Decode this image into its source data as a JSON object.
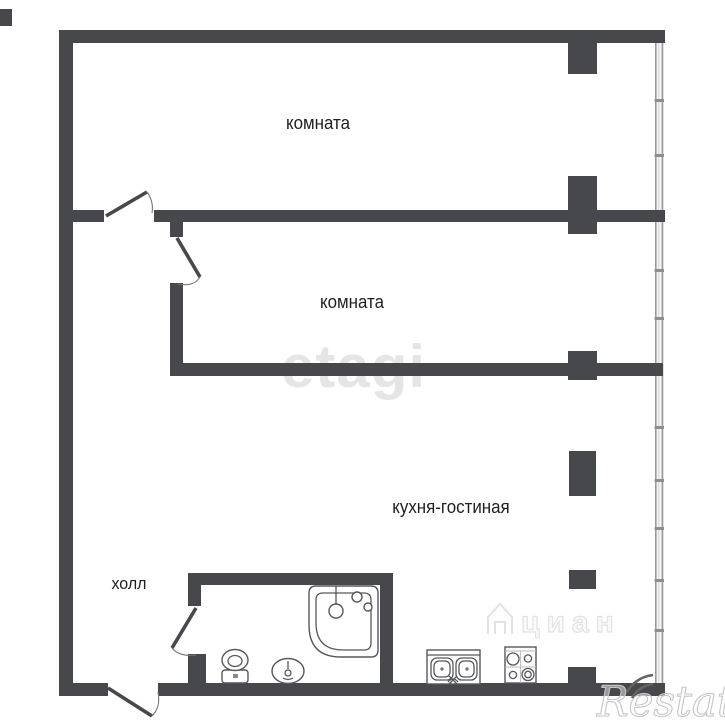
{
  "rooms": {
    "top": {
      "label": "комната"
    },
    "middle": {
      "label": "комната"
    },
    "kitchen_living": {
      "label": "кухня-гостиная"
    },
    "hall": {
      "label": "холл"
    }
  },
  "watermarks": {
    "etagi": {
      "text": "etagi"
    },
    "cian": {
      "text": "циан"
    },
    "restate": {
      "text": "Restate"
    }
  },
  "colors": {
    "wall": "#47484b",
    "window_line": "#9a9a9a",
    "fixture_line": "#56575b",
    "label_text": "#1f1f1f",
    "cian_outline": "#e2e2e2",
    "restate_outline": "#c6c6c6",
    "background": "#ffffff"
  },
  "icons": [
    "door-swing-icon",
    "window-glazing-icon",
    "bathtub-icon",
    "toilet-icon",
    "washbasin-icon",
    "kitchen-sink-icon",
    "stove-icon",
    "cian-house-icon",
    "restate-waves-icon"
  ]
}
